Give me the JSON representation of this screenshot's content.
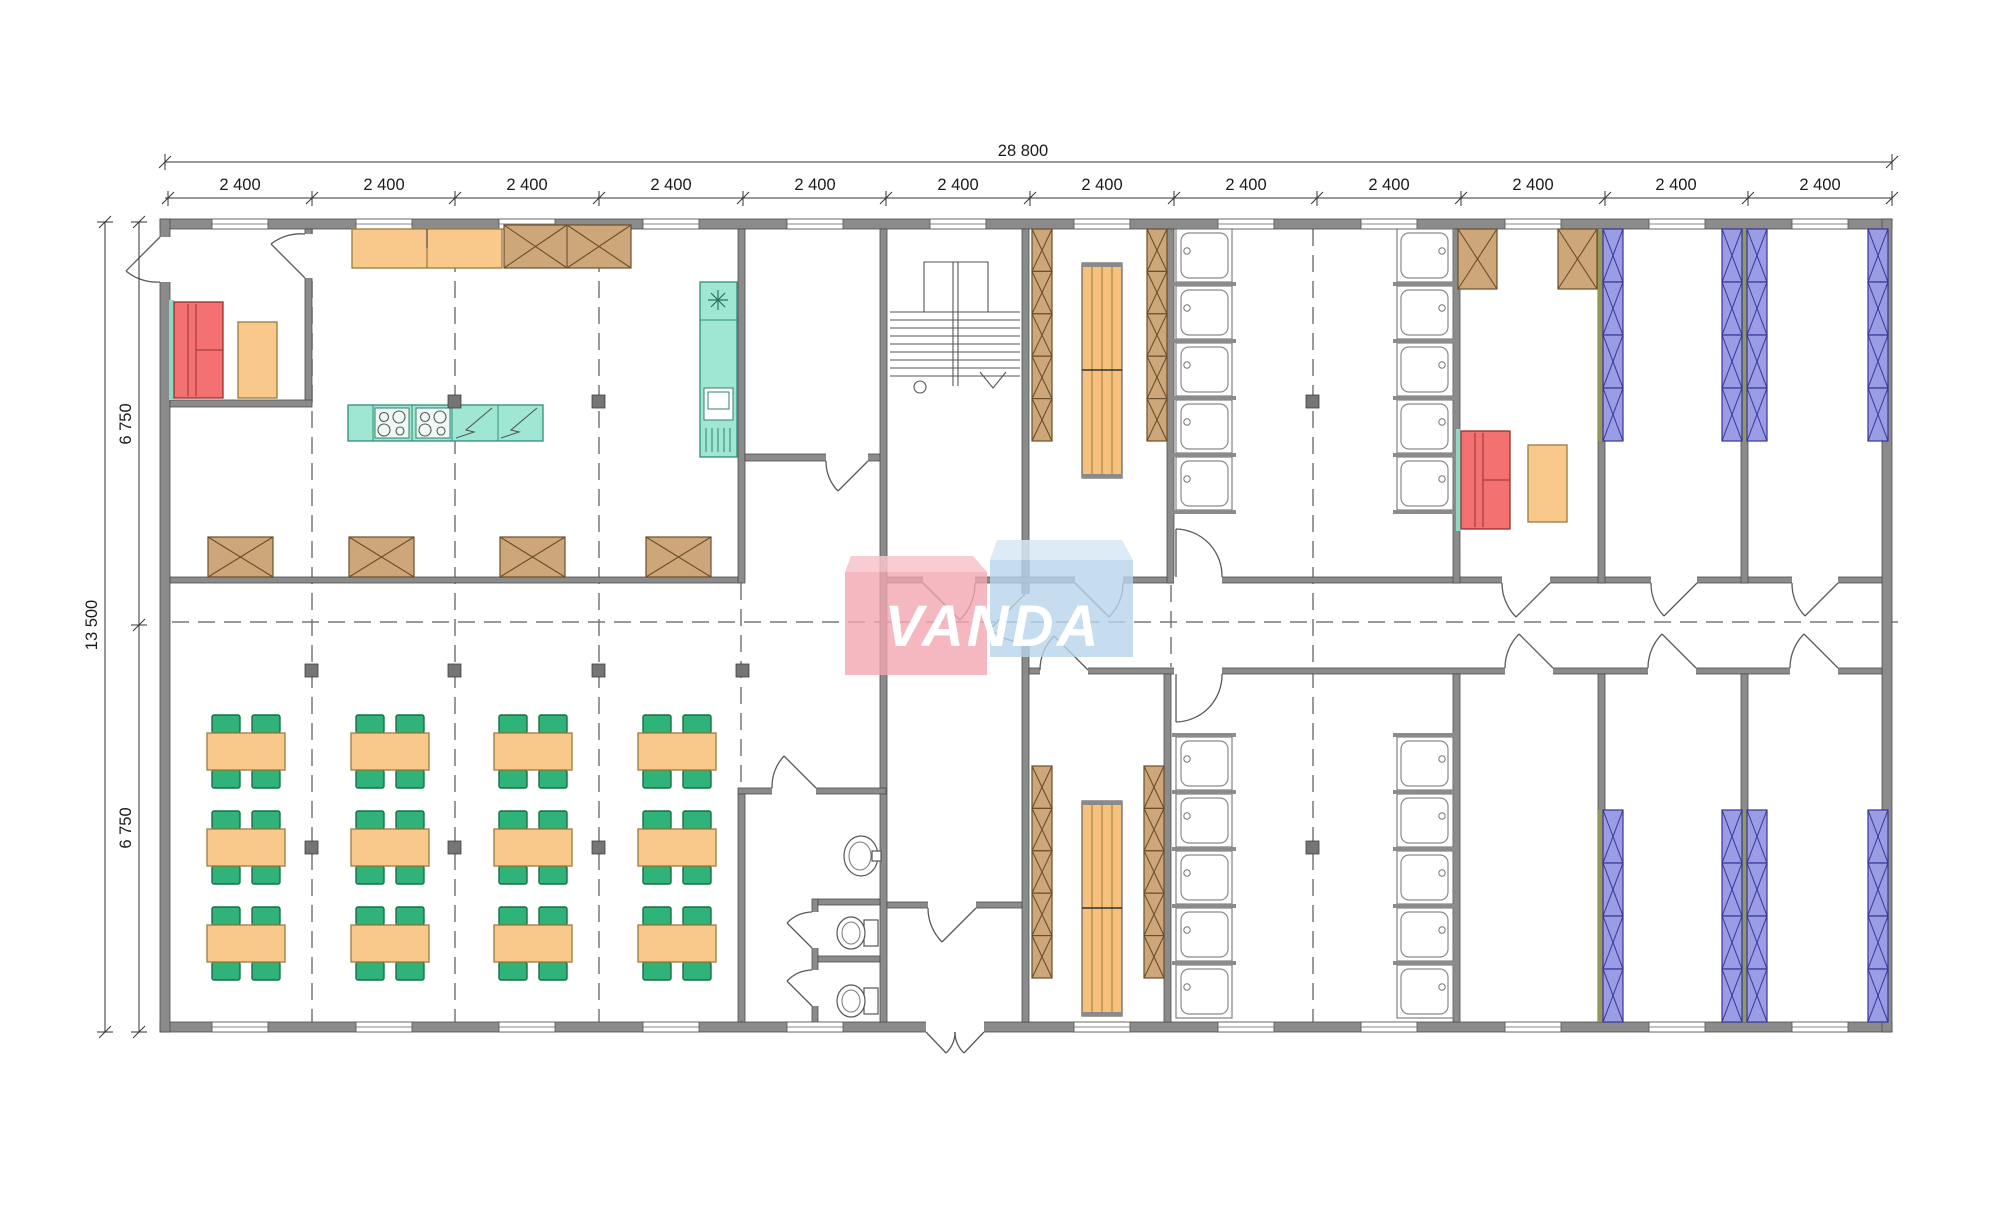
{
  "drawing": {
    "type": "architectural-floor-plan",
    "description": "Modular building floor plan: canteen with kitchen and dining tables on the left, entrance hall with staircase and WC in the middle, changing rooms with lockers and benches, shower rooms and bedrooms with bunk beds on the right",
    "grid_modules": 12
  },
  "dimensions": {
    "overall_width": "28 800",
    "overall_height": "13 500",
    "top_segments": [
      "2 400",
      "2 400",
      "2 400",
      "2 400",
      "2 400",
      "2 400",
      "2 400",
      "2 400",
      "2 400",
      "2 400",
      "2 400",
      "2 400"
    ],
    "left_segments": [
      "6 750",
      "6 750"
    ]
  },
  "logo": {
    "text": "VANDA",
    "pink_color": "#f2a6b2",
    "blue_color": "#b6d5ea"
  },
  "palette": {
    "wall_gray": "#8b8b8b",
    "bed_wall_olive": "#93995c",
    "furniture_orange": "#f9c98c",
    "chair_green": "#2fb378",
    "locker_tan": "#cda77a",
    "sofa_red": "#f37170",
    "kitchen_teal": "#9fe7d3",
    "bed_blue": "#9a9ce4",
    "bench_orange": "#f6c17d"
  },
  "symbols": [
    "dining-table-with-chairs",
    "folded-table",
    "kitchen-island-stove",
    "kitchen-sink-counter",
    "fridge",
    "wall-cabinet",
    "sofa",
    "coffee-table",
    "locker-column",
    "bench",
    "shower-stall",
    "bunk-bed-column",
    "toilet",
    "washbasin",
    "staircase",
    "door-swing",
    "window",
    "column-marker"
  ],
  "counts": {
    "dining_tables": 12,
    "shower_stalls": 20,
    "bed_columns": 8,
    "toilets": 2
  }
}
